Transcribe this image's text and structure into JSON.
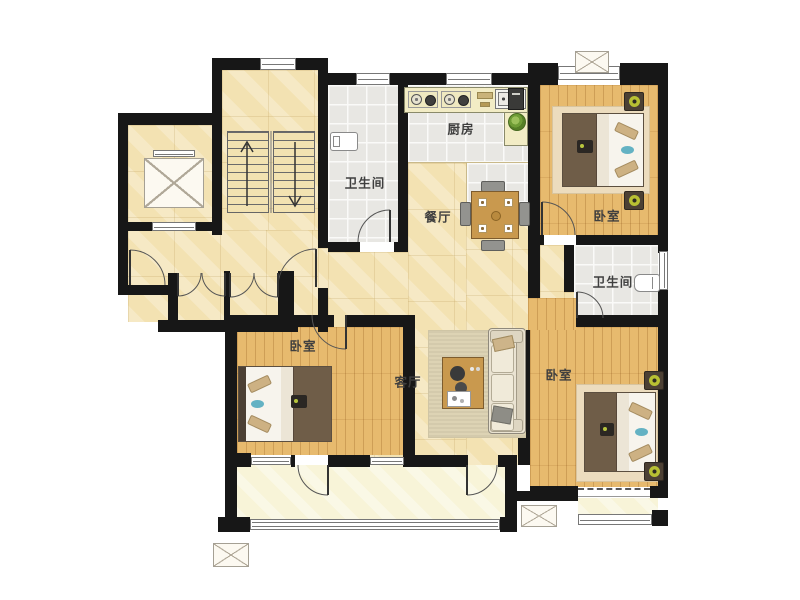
{
  "floorplan": {
    "type": "apartment-floor-plan",
    "rooms": {
      "kitchen": {
        "label": "厨房"
      },
      "bathroom_main": {
        "label": "卫生间"
      },
      "dining": {
        "label": "餐厅"
      },
      "bedroom_right_top": {
        "label": "卧室"
      },
      "bathroom_ensuite": {
        "label": "卫生间"
      },
      "bedroom_left": {
        "label": "卧室"
      },
      "living": {
        "label": "客厅"
      },
      "bedroom_right_bottom": {
        "label": "卧室"
      }
    },
    "colors": {
      "wall": "#171717",
      "hall_floor": "#f3e2b2",
      "wood_floor": "#e7ba6e",
      "tile_floor": "#e8e7e3",
      "balcony_floor": "#f8f4d8",
      "lamp_accent": "#b8c033",
      "pillow_accent": "#64b2c3"
    },
    "icons": [
      "elevator-icon",
      "staircase-icon",
      "ac-unit-icon",
      "door-swing-icon",
      "double-door-icon",
      "window-icon",
      "bed-icon",
      "sofa-icon",
      "coffee-table-icon",
      "dining-table-icon",
      "toilet-icon",
      "washer-icon",
      "sink-icon",
      "stove-icon",
      "fridge-icon",
      "plant-icon"
    ]
  }
}
